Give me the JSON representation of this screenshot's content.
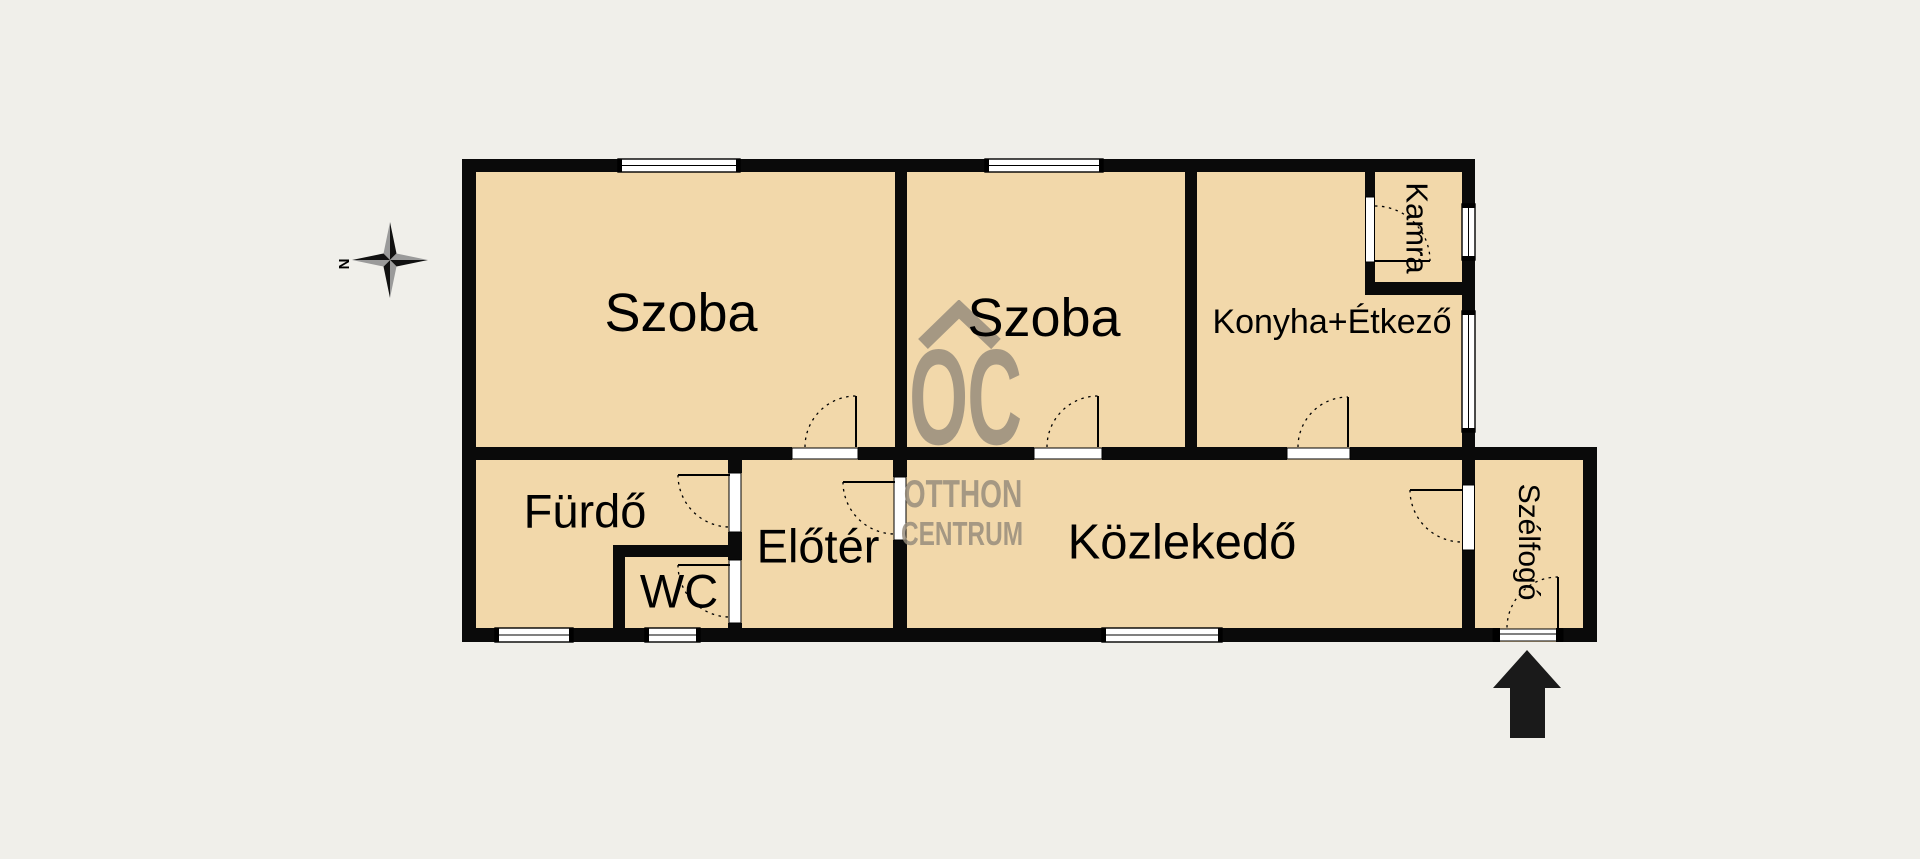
{
  "floorplan": {
    "rooms": [
      {
        "name": "szoba-1",
        "label": "Szoba"
      },
      {
        "name": "szoba-2",
        "label": "Szoba"
      },
      {
        "name": "konyha-etkezo",
        "label": "Konyha+Étkező"
      },
      {
        "name": "kamra",
        "label": "Kamra"
      },
      {
        "name": "furdo",
        "label": "Fürdő"
      },
      {
        "name": "wc",
        "label": "WC"
      },
      {
        "name": "eloter",
        "label": "Előtér"
      },
      {
        "name": "kozlekedo",
        "label": "Közlekedő"
      },
      {
        "name": "szelfogo",
        "label": "Szélfogó"
      }
    ],
    "compass": {
      "north_label": "N"
    },
    "watermark": {
      "logo": "OC",
      "line1": "OTTHON",
      "line2": "CENTRUM"
    },
    "colors": {
      "background": "#f0efea",
      "room_fill": "#f2d8aa",
      "wall": "#0a0a0a",
      "watermark": "#958b7b"
    }
  }
}
